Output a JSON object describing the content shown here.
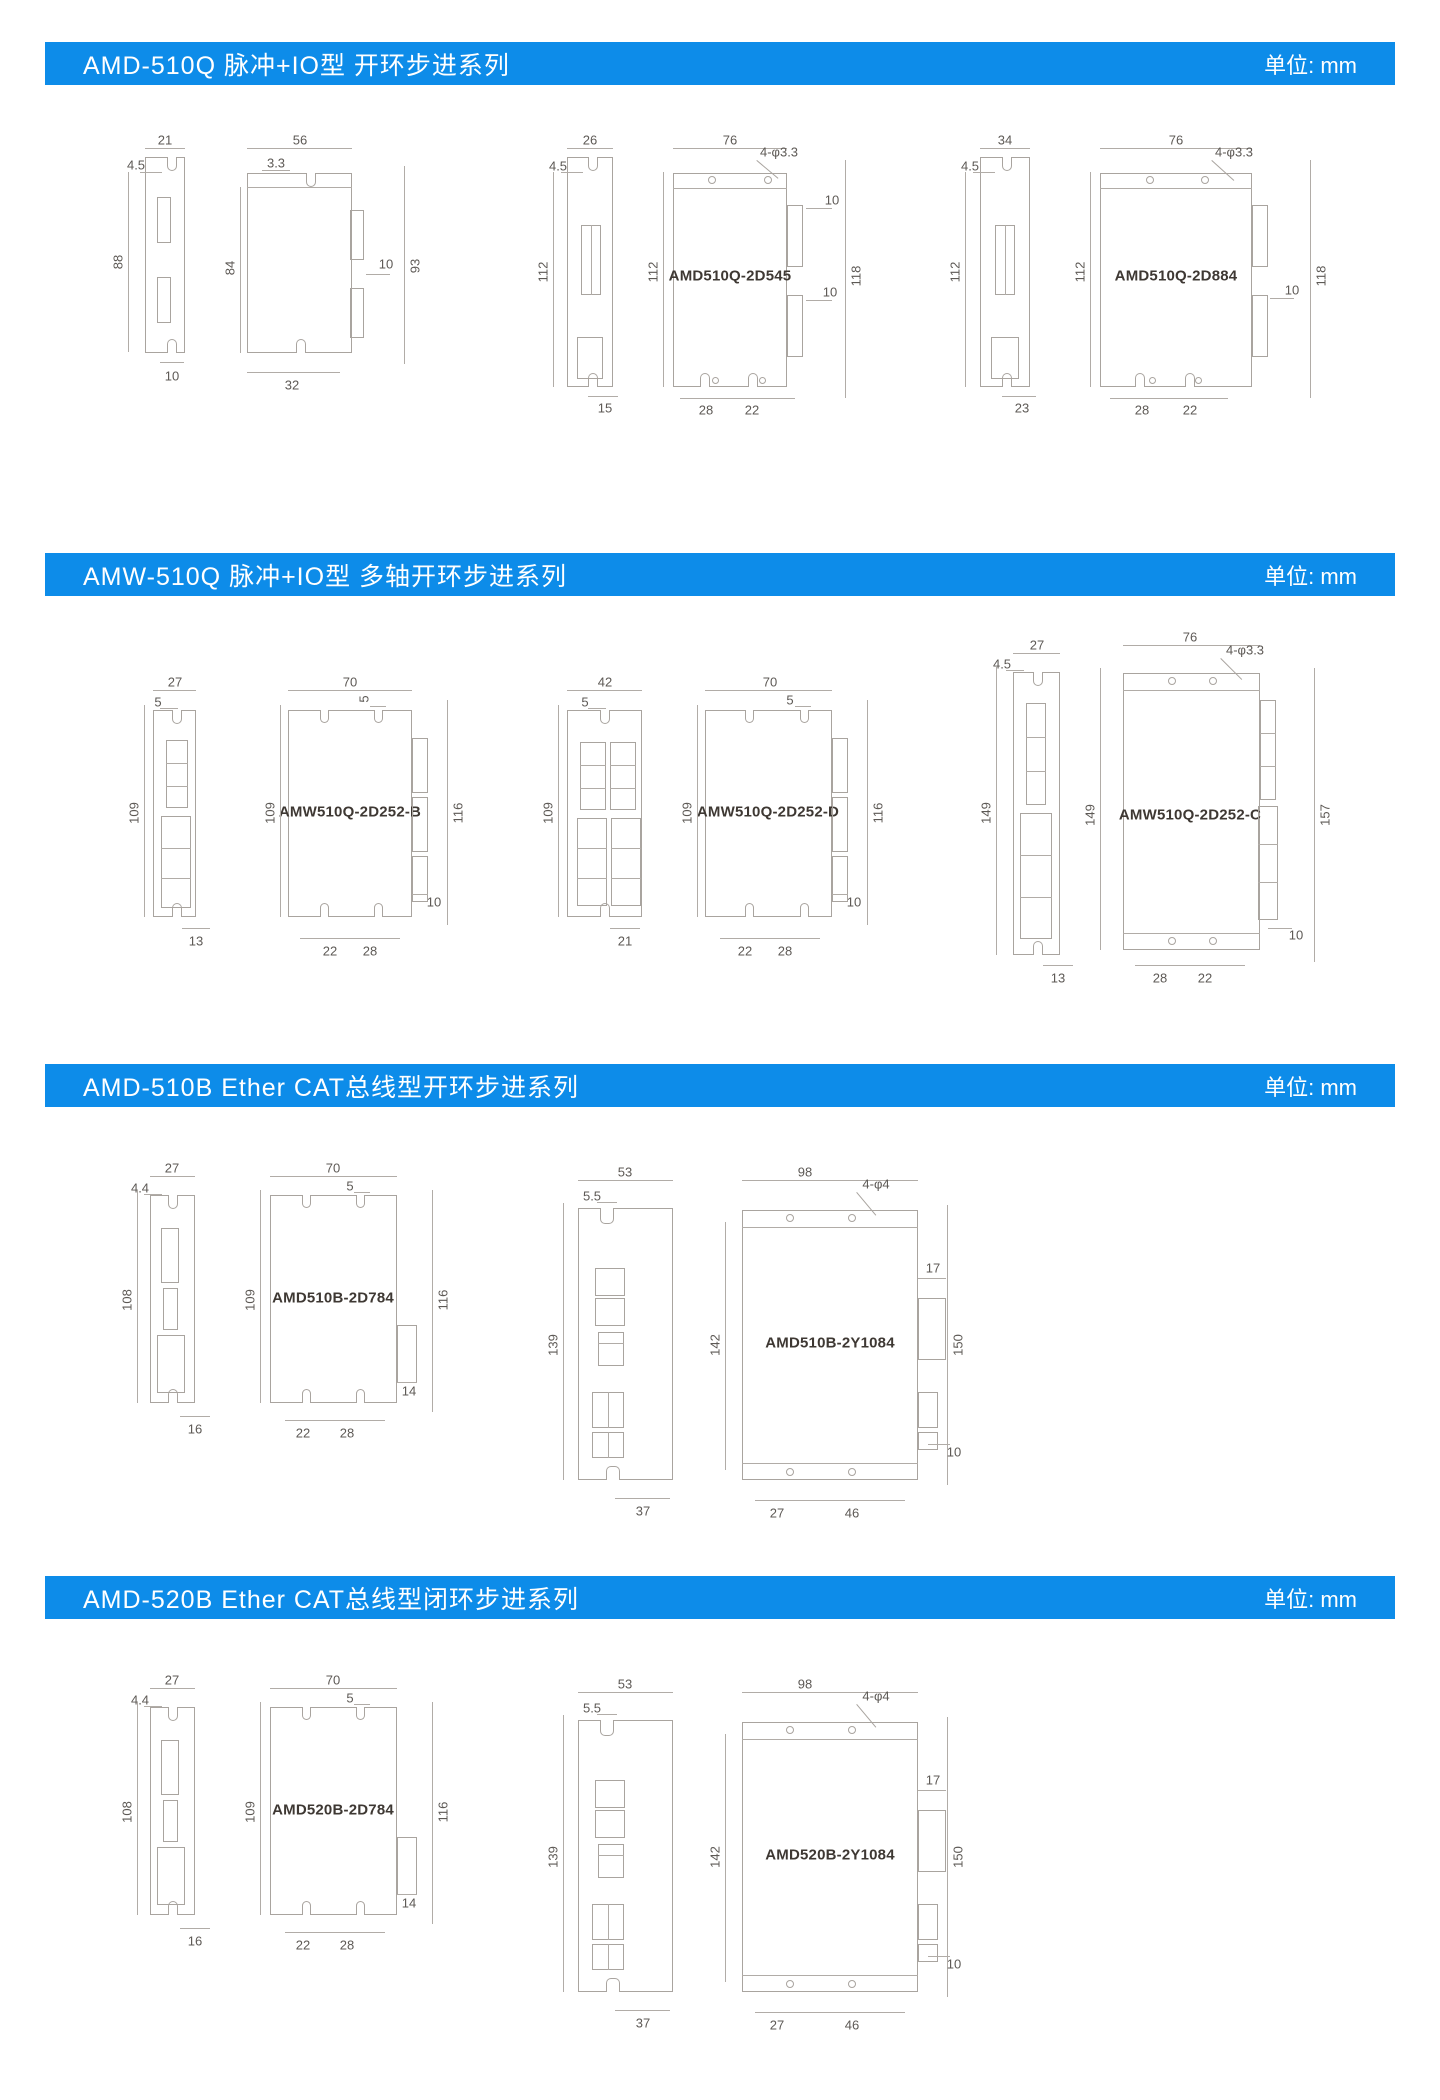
{
  "page": {
    "unit_label": "单位: mm"
  },
  "sections": [
    {
      "title": "AMD-510Q 脉冲+IO型 开环步进系列",
      "groups": [
        {
          "model": "AMD510Q-2D530",
          "dims": {
            "side_w": "21",
            "side_notch": "4.5",
            "side_h": "88",
            "side_b": "10",
            "front_w": "56",
            "front_notch": "3.3",
            "front_h": "84",
            "conn": "10",
            "total_h": "93",
            "bottom": "32"
          }
        },
        {
          "model": "AMD510Q-2D545",
          "dims": {
            "side_w": "26",
            "side_notch": "4.5",
            "side_h": "112",
            "side_b": "15",
            "front_w": "76",
            "holes": "4-φ3.3",
            "front_h": "112",
            "conn1": "10",
            "conn2": "10",
            "total_h": "118",
            "b1": "28",
            "b2": "22"
          }
        },
        {
          "model": "AMD510Q-2D884",
          "dims": {
            "side_w": "34",
            "side_notch": "4.5",
            "side_h": "112",
            "side_b": "23",
            "front_w": "76",
            "holes": "4-φ3.3",
            "front_h": "112",
            "conn": "10",
            "total_h": "118",
            "b1": "28",
            "b2": "22"
          }
        }
      ]
    },
    {
      "title": "AMW-510Q 脉冲+IO型 多轴开环步进系列",
      "groups": [
        {
          "model": "AMW510Q-2D252-B",
          "dims": {
            "side_w": "27",
            "side_notch": "5",
            "side_h": "109",
            "side_b": "13",
            "front_w": "70",
            "front_notch": "5",
            "front_h": "109",
            "right_h": "116",
            "conn": "10",
            "b1": "22",
            "b2": "28"
          }
        },
        {
          "model": "AMW510Q-2D252-D",
          "dims": {
            "side_w": "42",
            "side_notch": "5",
            "side_h": "109",
            "side_b": "21",
            "front_w": "70",
            "front_notch": "5",
            "front_h": "109",
            "right_h": "116",
            "conn": "10",
            "b1": "22",
            "b2": "28"
          }
        },
        {
          "model": "AMW510Q-2D252-C",
          "dims": {
            "side_w": "27",
            "side_notch": "4.5",
            "side_h": "149",
            "side_b": "13",
            "front_w": "76",
            "holes": "4-φ3.3",
            "front_h": "149",
            "right_h": "157",
            "conn": "10",
            "b1": "28",
            "b2": "22"
          }
        }
      ]
    },
    {
      "title": "AMD-510B Ether CAT总线型开环步进系列",
      "groups": [
        {
          "model": "AMD510B-2D784",
          "dims": {
            "side_w": "27",
            "side_notch": "4.4",
            "side_h": "108",
            "side_b": "16",
            "front_w": "70",
            "front_notch": "5",
            "front_h": "109",
            "right_h": "116",
            "conn": "14",
            "b1": "22",
            "b2": "28"
          }
        },
        {
          "model": "AMD510B-2Y1084",
          "dims": {
            "side_w": "53",
            "side_notch": "5.5",
            "side_h": "139",
            "side_b": "37",
            "front_w": "98",
            "holes": "4-φ4",
            "front_h": "142",
            "right_h": "150",
            "conn_top": "17",
            "conn_bot": "10",
            "b1": "27",
            "b2": "46"
          }
        }
      ]
    },
    {
      "title": "AMD-520B Ether CAT总线型闭环步进系列",
      "groups": [
        {
          "model": "AMD520B-2D784",
          "dims": {
            "side_w": "27",
            "side_notch": "4.4",
            "side_h": "108",
            "side_b": "16",
            "front_w": "70",
            "front_notch": "5",
            "front_h": "109",
            "right_h": "116",
            "conn": "14",
            "b1": "22",
            "b2": "28"
          }
        },
        {
          "model": "AMD520B-2Y1084",
          "dims": {
            "side_w": "53",
            "side_notch": "5.5",
            "side_h": "139",
            "side_b": "37",
            "front_w": "98",
            "holes": "4-φ4",
            "front_h": "142",
            "right_h": "150",
            "conn_top": "17",
            "conn_bot": "10",
            "b1": "27",
            "b2": "46"
          }
        }
      ]
    }
  ]
}
